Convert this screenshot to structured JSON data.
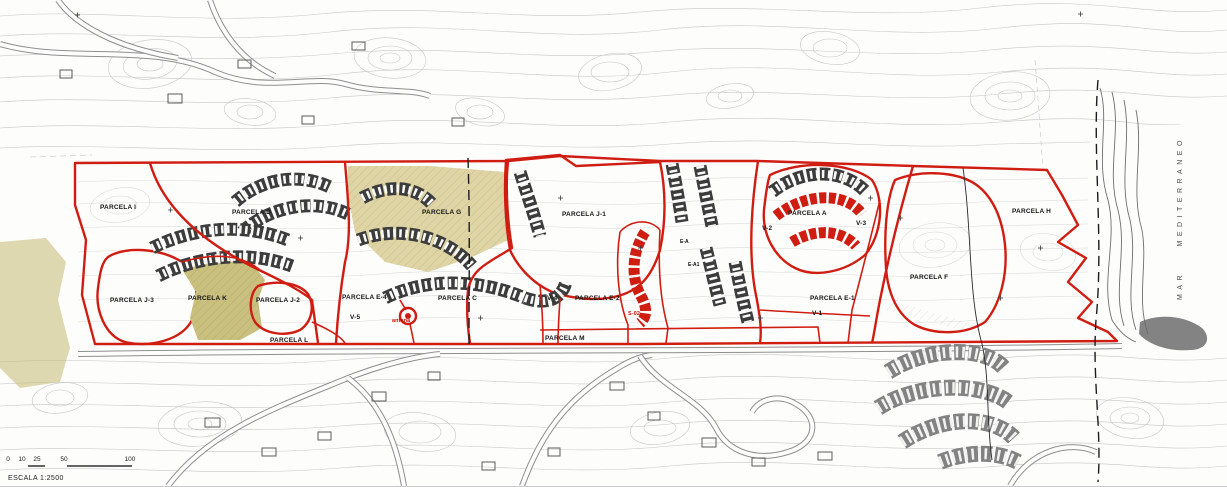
{
  "colors": {
    "boundary_red": "#d01d12",
    "building_red": "#d01d12",
    "parcel_yellow": "#f2ec20",
    "parcel_tan": "#ded4a4",
    "parcel_olive": "#c9c07e",
    "existing_gray": "#828282",
    "annotation_red": "#c41108"
  },
  "labels": {
    "parcela_i": "PARCELA I",
    "parcela_d": "PARCELA D",
    "parcela_j3": "PARCELA J-3",
    "parcela_k": "PARCELA K",
    "parcela_j2": "PARCELA J-2",
    "parcela_l": "PARCELA L",
    "parcela_e4": "PARCELA E-4",
    "parcela_g": "PARCELA G",
    "parcela_c": "PARCELA C",
    "parcela_j1": "PARCELA J-1",
    "parcela_e2": "PARCELA E-2",
    "parcela_m": "PARCELA M",
    "parcela_a": "PARCELA A",
    "parcela_e1": "PARCELA E-1",
    "parcela_f": "PARCELA F",
    "parcela_h": "PARCELA H"
  },
  "roads": {
    "v1": "V-1",
    "v2": "V-2",
    "v3": "V-3",
    "v4": "V-4",
    "v5": "V-5"
  },
  "annotations": {
    "antena": "antena",
    "s02": "S-02",
    "ea": "E-A",
    "ea1": "E-A1"
  },
  "sea": {
    "label": "MAR MEDITERRANEO"
  },
  "scale_bar": {
    "title": "ESCALA 1:2500",
    "ticks": [
      "0",
      "10",
      "25",
      "50",
      "100"
    ]
  }
}
